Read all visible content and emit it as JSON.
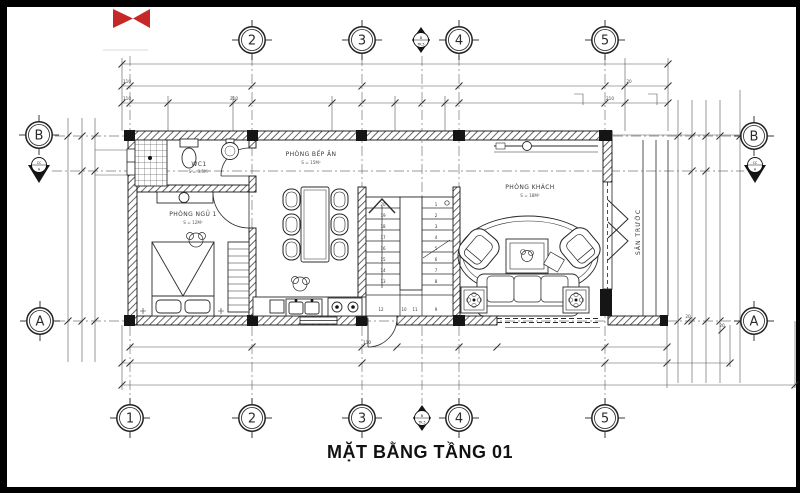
{
  "title": "MẶT BẰNG TẦNG 01",
  "colors": {
    "paper": "#ffffff",
    "ink": "#2b2b2b",
    "frame": "#000000",
    "logo_red": "#c62828"
  },
  "grid": {
    "cols": [
      "1",
      "2",
      "3",
      "4",
      "5"
    ],
    "rows": {
      "left_b": "B",
      "left_a": "A",
      "right_b": "B",
      "right_a": "A"
    }
  },
  "markers": {
    "b_section": {
      "top": "B",
      "bottom": "TK.5"
    },
    "cc_section": {
      "top": "CC",
      "bottom": "A"
    }
  },
  "rooms": {
    "wc": {
      "name": "WC1",
      "area": "S = 3.5M²"
    },
    "bedroom": {
      "name": "PHÒNG NGỦ 1",
      "area": "S = 12M²"
    },
    "kitchen": {
      "name": "PHÒNG BẾP ĂN",
      "area": "S = 15M²"
    },
    "living": {
      "name": "PHÒNG KHÁCH",
      "area": "S = 18M²"
    },
    "porch": {
      "name": "SÂN TRƯỚC"
    }
  },
  "stairs": {
    "left": [
      "20",
      "19",
      "18",
      "17",
      "16",
      "15",
      "14",
      "13"
    ],
    "right": [
      "1",
      "2",
      "3",
      "4",
      "5",
      "6",
      "7",
      "8"
    ],
    "landing": [
      "12",
      "10",
      "11",
      "9"
    ]
  },
  "dims": {
    "t1": "110",
    "t2": "110",
    "t3": "210",
    "t4": "210",
    "t5": "20",
    "b1": "110",
    "r1": "20",
    "r2": "20"
  }
}
